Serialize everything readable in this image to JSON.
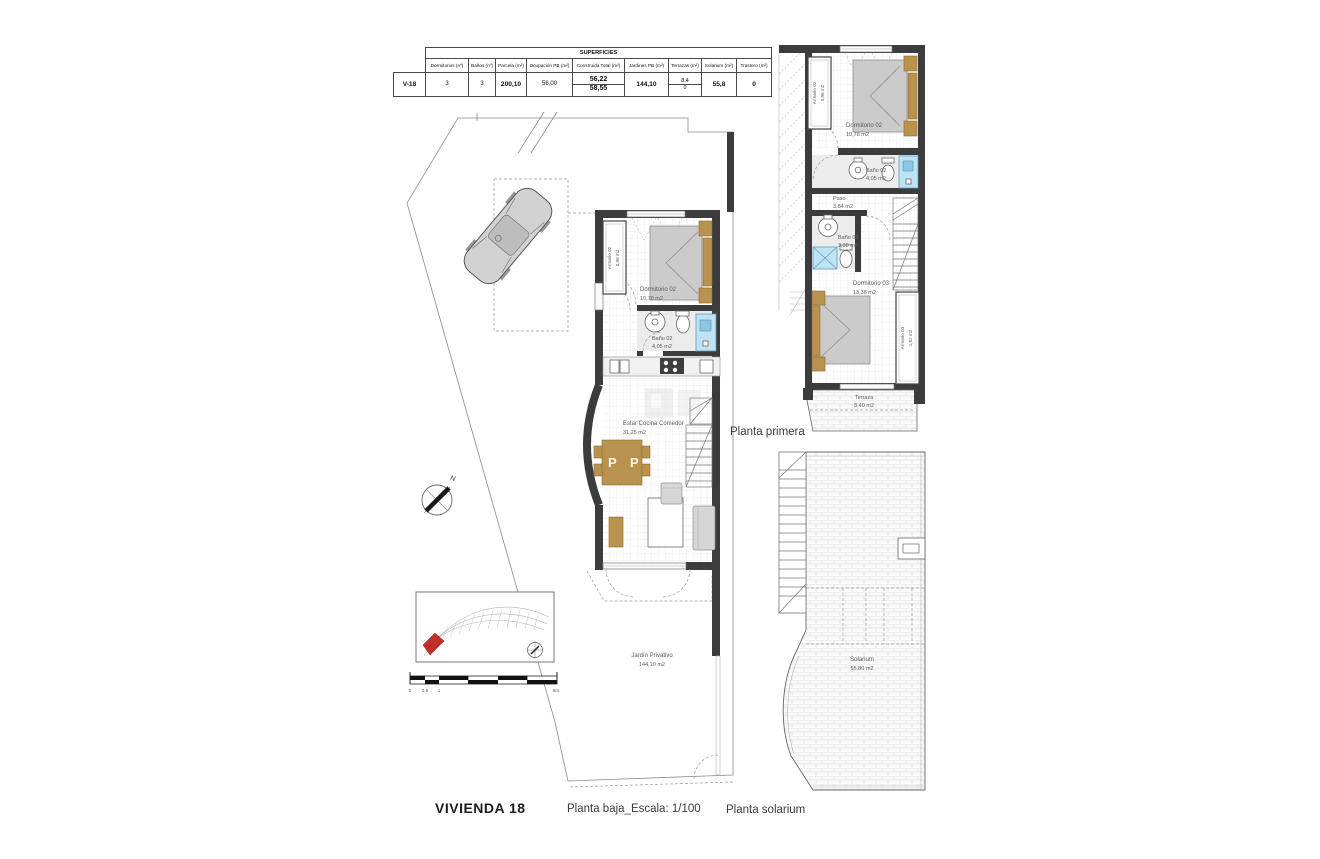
{
  "surfaces_table": {
    "title": "SUPERFICIES",
    "row_label": "V-18",
    "columns": [
      "Dormitorios (nº)",
      "Baños (nº)",
      "Parcela (m²)",
      "Ocupación PB (m²)",
      "Construida Total (m²)",
      "Jardines PB (m²)",
      "Terrazas (m²)",
      "Solarium (m²)",
      "Trastero (m²)"
    ],
    "values": {
      "dormitorios": "3",
      "banos": "3",
      "parcela": "200,10",
      "ocupacion_pb": "56,00",
      "construida_total_pb": "56,22",
      "construida_total_p1": "58,55",
      "jardines_pb": "144,10",
      "terrazas_p1": "8,4",
      "terrazas_ps": "0",
      "solarium": "55,8",
      "trastero": "0"
    }
  },
  "planta_baja": {
    "armario02_name": "Armario 02",
    "armario02_area": "0,96 m2",
    "dormitorio02_name": "Dormitorio 02",
    "dormitorio02_area": "10,78 m2",
    "bano02_name": "Baño 02",
    "bano02_area": "4,05 m2",
    "estar_name": "Estar Cocina Comedor",
    "estar_area": "31,25 m2",
    "watermark": "P P",
    "jardin_name": "Jardín Privativo",
    "jardin_area": "144,10 m2",
    "compass_n": "N"
  },
  "scale_bar": {
    "t0": "0",
    "t05": "0.5",
    "t1": "1",
    "t5": "5m"
  },
  "planta_primera": {
    "label": "Planta primera",
    "armario02_name": "Armario 02",
    "armario02_area": "0,96 m2",
    "dormitorio02_name": "Dormitorio 02",
    "dormitorio02_area": "10,78 m2",
    "bano02_name": "Baño 02",
    "bano02_area": "4,05 m2",
    "paso_name": "Paso",
    "paso_area": "3,84 m2",
    "bano03_name": "Baño 03",
    "bano03_area": "3,30 m2",
    "dormitorio03_name": "Dormitorio 03",
    "dormitorio03_area": "13,38 m2",
    "armario03_name": "Armario 03",
    "armario03_area": "1,62 m2",
    "terraza_name": "Terraza",
    "terraza_area": "8,40 m2"
  },
  "planta_solarium": {
    "label": "Planta solarium",
    "solarium_name": "Solarium",
    "solarium_area": "55,80 m2"
  },
  "footer": {
    "title": "VIVIENDA 18",
    "scale_label": "Planta baja_Escala: 1/100"
  }
}
